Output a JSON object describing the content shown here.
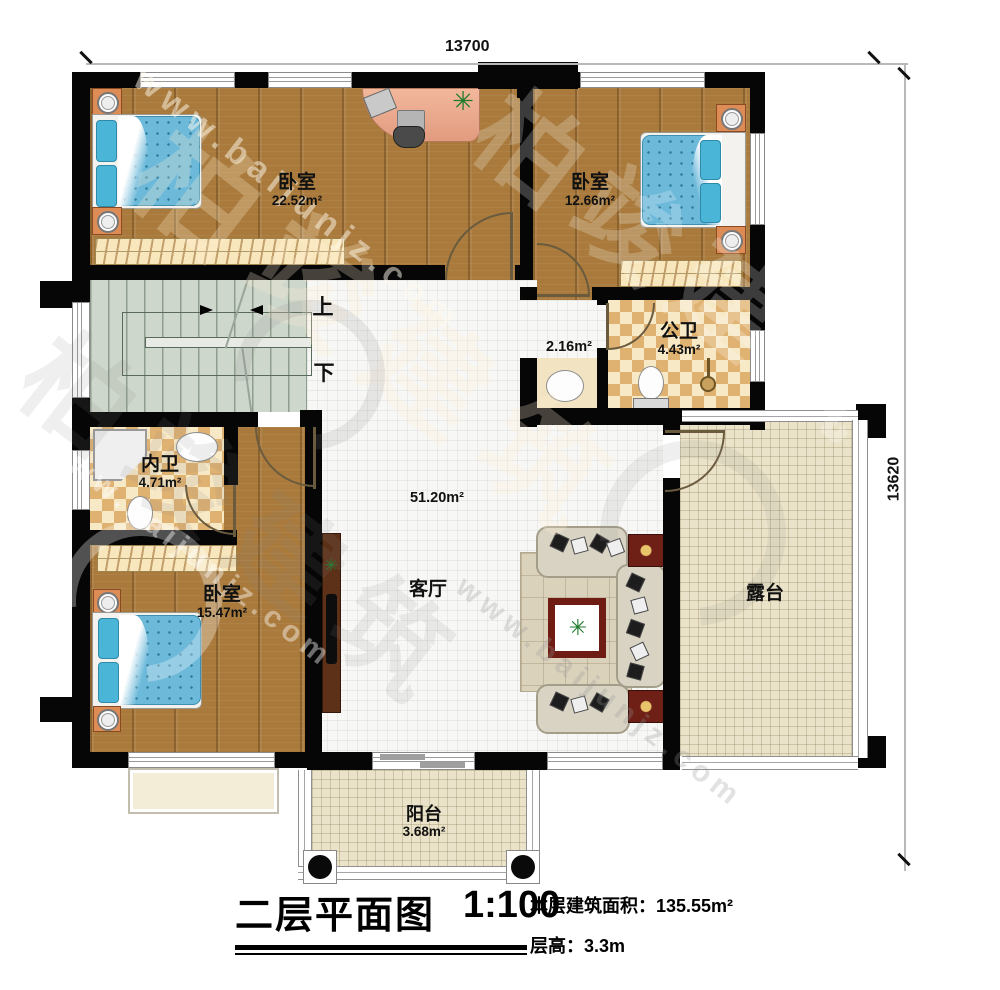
{
  "plan": {
    "dimensions": {
      "width_mm": "13700",
      "height_mm": "13620"
    },
    "rooms": [
      {
        "id": "bedroom-top-left",
        "name": "卧室",
        "area": "22.52m²"
      },
      {
        "id": "bedroom-top-right",
        "name": "卧室",
        "area": "12.66m²"
      },
      {
        "id": "wash-anteroom",
        "name": "",
        "area": "2.16m²"
      },
      {
        "id": "public-bathroom",
        "name": "公卫",
        "area": "4.43m²"
      },
      {
        "id": "ensuite-bathroom",
        "name": "内卫",
        "area": "4.71m²"
      },
      {
        "id": "bedroom-bottom",
        "name": "卧室",
        "area": "15.47m²"
      },
      {
        "id": "living-room",
        "name": "客厅",
        "area": "51.20m²"
      },
      {
        "id": "terrace",
        "name": "露台",
        "area": ""
      },
      {
        "id": "balcony",
        "name": "阳台",
        "area": "3.68m²"
      }
    ],
    "stairs": {
      "up": "上",
      "down": "下"
    },
    "title_block": {
      "title": "二层平面图",
      "scale": "1:100",
      "floor_area_label": "本层建筑面积：",
      "floor_area_value": "135.55m²",
      "floor_height_label": "层高：",
      "floor_height_value": "3.3m"
    },
    "watermark": {
      "brand": "柏竣建筑",
      "url": "www.baijunjz.com"
    }
  }
}
